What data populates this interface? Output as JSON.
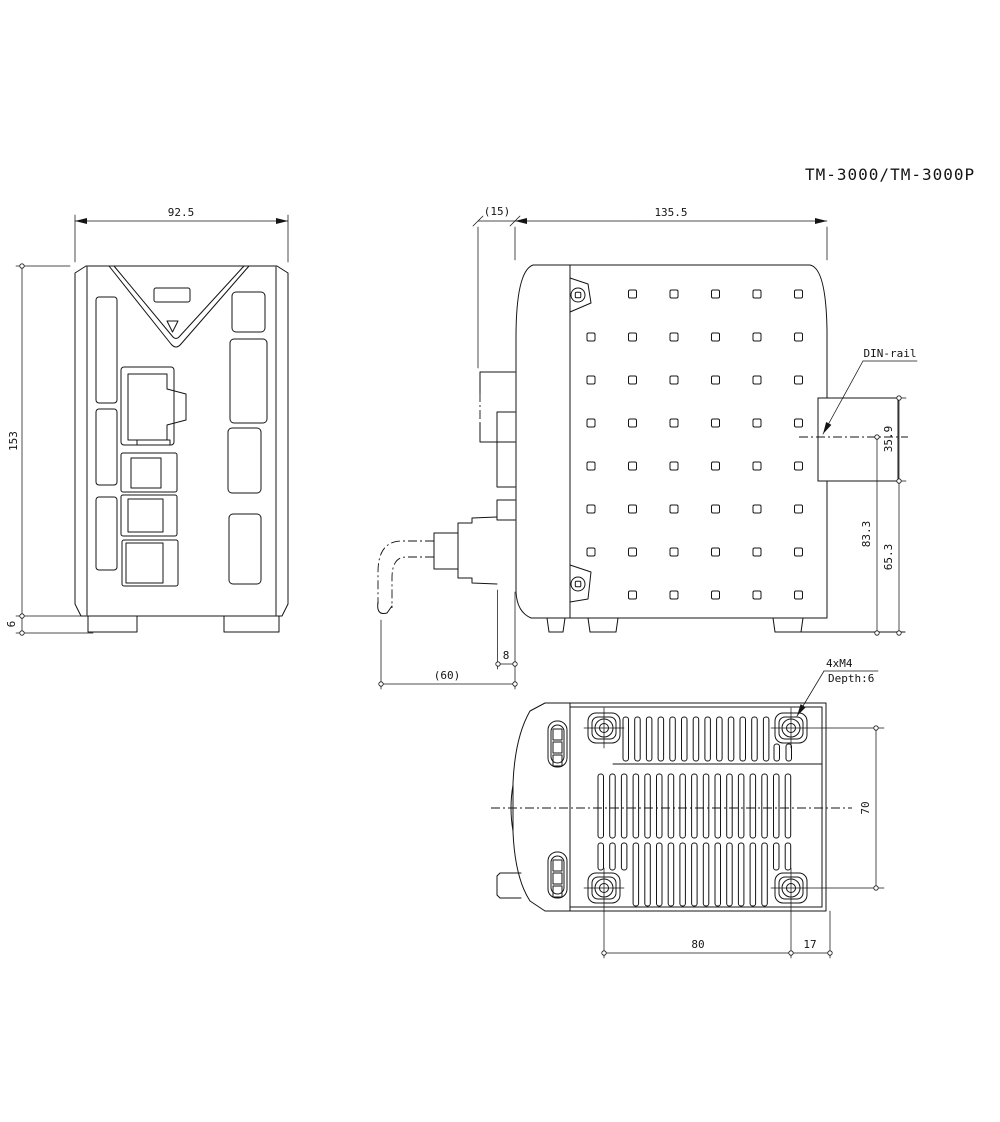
{
  "title": "TM-3000/TM-3000P",
  "front_view": {
    "width_dim": "92.5",
    "height_dim": "153",
    "foot_height_dim": "6"
  },
  "side_view": {
    "front_protrusion_dim": "(15)",
    "body_depth_dim": "135.5",
    "din_rail_label": "DIN-rail",
    "din_rail_height_dim": "35.9",
    "rail_center_to_base_dim": "83.3",
    "rail_bottom_to_base_dim": "65.3",
    "connector_face_dim": "8",
    "cable_clearance_dim": "(60)"
  },
  "bottom_view": {
    "screw_spec_line1": "4xM4",
    "screw_spec_line2": "Depth:6",
    "mount_hole_vertical_dim": "70",
    "mount_hole_horizontal_dim": "80",
    "edge_offset_dim": "17"
  }
}
